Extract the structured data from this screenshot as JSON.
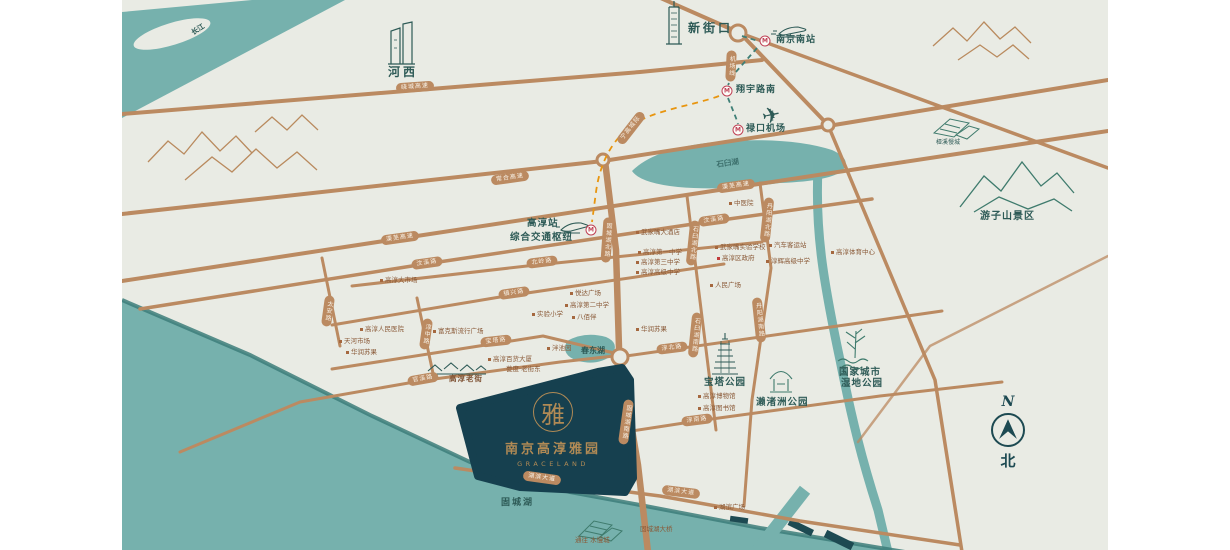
{
  "map": {
    "logo": {
      "title": "南京高淳雅园",
      "subtitle": "GRACELAND",
      "seal": "雅"
    },
    "compass": {
      "n": "N",
      "north": "北"
    },
    "metro_m": "M",
    "colors": {
      "background": "#e9ebe4",
      "water": "#76b1ad",
      "water_edge": "#3d7e7a",
      "road": "#bb8a61",
      "site_polygon": "#16404f",
      "gold": "#b08a55",
      "teal_label": "#2d5a56",
      "poi_label": "#8a5a38",
      "metro_red": "#bf4055",
      "metro_line_s9": "#e8950f",
      "metro_line_s1": "#3f7f76"
    },
    "metro_stations": [
      {
        "x": 765,
        "y": 41
      },
      {
        "x": 727,
        "y": 91
      },
      {
        "x": 738,
        "y": 130
      },
      {
        "x": 591,
        "y": 230
      }
    ],
    "road_pills": [
      {
        "label": "绕城高速",
        "x": 415,
        "y": 87,
        "rot": -4
      },
      {
        "label": "常合高速",
        "x": 510,
        "y": 178,
        "rot": -8
      },
      {
        "label": "溧芜高速",
        "x": 400,
        "y": 238,
        "rot": -8
      },
      {
        "label": "溧芜高速",
        "x": 736,
        "y": 186,
        "rot": -8
      },
      {
        "label": "汶溪路",
        "x": 427,
        "y": 263,
        "rot": -8
      },
      {
        "label": "汶溪路",
        "x": 714,
        "y": 220,
        "rot": -8
      },
      {
        "label": "北岭路",
        "x": 542,
        "y": 262,
        "rot": -7
      },
      {
        "label": "镇兴路",
        "x": 514,
        "y": 293,
        "rot": -8
      },
      {
        "label": "宝塔路",
        "x": 496,
        "y": 341,
        "rot": -6
      },
      {
        "label": "淳北路",
        "x": 672,
        "y": 348,
        "rot": -7
      },
      {
        "label": "官溪路",
        "x": 423,
        "y": 379,
        "rot": -10
      },
      {
        "label": "淳南路",
        "x": 697,
        "y": 420,
        "rot": -7
      },
      {
        "label": "湖滨大道",
        "x": 542,
        "y": 478,
        "rot": 8
      },
      {
        "label": "湖滨大道",
        "x": 681,
        "y": 492,
        "rot": 7
      },
      {
        "label": "宁高城际",
        "x": 631,
        "y": 128,
        "rot": -52
      },
      {
        "label": "机场线",
        "x": 731,
        "y": 66,
        "rot": 3,
        "vertical": true
      },
      {
        "label": "太安路",
        "x": 328,
        "y": 311,
        "rot": 8,
        "vertical": true
      },
      {
        "label": "淳中路",
        "x": 426,
        "y": 334,
        "rot": 8,
        "vertical": true
      },
      {
        "label": "固城湖北路",
        "x": 607,
        "y": 240,
        "rot": 4,
        "vertical": true
      },
      {
        "label": "石臼湖北路",
        "x": 693,
        "y": 243,
        "rot": 6,
        "vertical": true
      },
      {
        "label": "丹阳湖北路",
        "x": 767,
        "y": 220,
        "rot": 6,
        "vertical": true
      },
      {
        "label": "石臼湖南路",
        "x": 695,
        "y": 335,
        "rot": 6,
        "vertical": true
      },
      {
        "label": "丹阳湖南路",
        "x": 759,
        "y": 320,
        "rot": -6,
        "vertical": true
      },
      {
        "label": "固城湖南路",
        "x": 626,
        "y": 422,
        "rot": 8,
        "vertical": true
      }
    ],
    "area_labels": [
      {
        "id": "changjiang",
        "text": "长江",
        "x": 190,
        "y": 30,
        "size": 7,
        "rot": -33
      },
      {
        "id": "hexi",
        "text": "河西",
        "x": 388,
        "y": 66,
        "size": 12,
        "ls": 3
      },
      {
        "id": "xinjiekou",
        "text": "新街口",
        "x": 688,
        "y": 22,
        "size": 12,
        "ls": 3
      },
      {
        "id": "nanjing-south",
        "text": "南京南站",
        "x": 776,
        "y": 36,
        "size": 9,
        "ls": 1
      },
      {
        "id": "xiangyu-south",
        "text": "翔宇路南",
        "x": 736,
        "y": 86,
        "size": 9,
        "ls": 1
      },
      {
        "id": "lukou-airport",
        "text": "禄口机场",
        "x": 746,
        "y": 125,
        "size": 9,
        "ls": 1
      },
      {
        "id": "gaochun-station",
        "text": "高淳站",
        "x": 527,
        "y": 219,
        "size": 9.5,
        "ls": 1
      },
      {
        "id": "transport-hub",
        "text": "综合交通枢纽",
        "x": 510,
        "y": 233,
        "size": 9.5,
        "ls": 1
      },
      {
        "id": "shijiu-lake",
        "text": "石臼湖",
        "x": 716,
        "y": 161,
        "size": 7.5,
        "rot": -8,
        "color": "#3c6f6c"
      },
      {
        "id": "yaxi",
        "text": "桠溪慢城",
        "x": 936,
        "y": 140,
        "size": 6,
        "bold": false
      },
      {
        "id": "youzishan",
        "text": "游子山景区",
        "x": 980,
        "y": 212,
        "size": 10,
        "ls": 1
      },
      {
        "id": "wetland-1",
        "text": "国家城市",
        "x": 839,
        "y": 368,
        "size": 9.5,
        "ls": 1
      },
      {
        "id": "wetland-2",
        "text": "湿地公园",
        "x": 841,
        "y": 379,
        "size": 9.5,
        "ls": 1
      },
      {
        "id": "baota-park",
        "text": "宝塔公园",
        "x": 704,
        "y": 378,
        "size": 9.5,
        "ls": 1
      },
      {
        "id": "laizhuzhou-park",
        "text": "濑渚洲公园",
        "x": 756,
        "y": 398,
        "size": 9.5,
        "ls": 1
      },
      {
        "id": "chundong-lake",
        "text": "春东湖",
        "x": 581,
        "y": 346,
        "size": 8
      },
      {
        "id": "gucheng-lake",
        "text": "固城湖",
        "x": 501,
        "y": 499,
        "size": 9,
        "ls": 2
      },
      {
        "id": "gaochun-old-street",
        "text": "高淳老街",
        "x": 449,
        "y": 375,
        "size": 7.5,
        "color": "#7c4f30",
        "ls": 1
      }
    ],
    "pois": [
      {
        "text": "高淳大市场",
        "x": 380,
        "y": 277,
        "dot": true
      },
      {
        "text": "高淳人民医院",
        "x": 360,
        "y": 326,
        "dot": true
      },
      {
        "text": "天河市场",
        "x": 339,
        "y": 338,
        "dot": true
      },
      {
        "text": "华润苏果",
        "x": 346,
        "y": 349,
        "dot": true
      },
      {
        "text": "富克斯流行广场",
        "x": 433,
        "y": 328,
        "dot": true
      },
      {
        "text": "中医院",
        "x": 729,
        "y": 200,
        "dot": true
      },
      {
        "text": "武家嘴大酒店",
        "x": 636,
        "y": 229,
        "dot": true
      },
      {
        "text": "高淳第一中学",
        "x": 638,
        "y": 249,
        "dot": true
      },
      {
        "text": "高淳第三中学",
        "x": 636,
        "y": 259,
        "dot": true
      },
      {
        "text": "高淳高级中学",
        "x": 636,
        "y": 269,
        "dot": true
      },
      {
        "text": "武家嘴实验学校",
        "x": 715,
        "y": 244,
        "dot": true
      },
      {
        "text": "高淳区政府",
        "x": 717,
        "y": 255,
        "dot": true,
        "red": true
      },
      {
        "text": "人民广场",
        "x": 710,
        "y": 282,
        "dot": true
      },
      {
        "text": "汽车客运站",
        "x": 769,
        "y": 242,
        "dot": true
      },
      {
        "text": "淳辉高级中学",
        "x": 766,
        "y": 258,
        "dot": true
      },
      {
        "text": "高淳体育中心",
        "x": 831,
        "y": 249,
        "dot": true
      },
      {
        "text": "悦达广场",
        "x": 570,
        "y": 290,
        "dot": true
      },
      {
        "text": "高淳第二中学",
        "x": 565,
        "y": 302,
        "dot": true
      },
      {
        "text": "实验小学",
        "x": 532,
        "y": 311,
        "dot": true
      },
      {
        "text": "八佰伴",
        "x": 572,
        "y": 314,
        "dot": true
      },
      {
        "text": "华润苏果",
        "x": 636,
        "y": 326,
        "dot": true
      },
      {
        "text": "泮池园",
        "x": 547,
        "y": 345,
        "dot": true
      },
      {
        "text": "高淳百货大厦",
        "x": 488,
        "y": 356,
        "dot": true
      },
      {
        "text": "甍度·老街东",
        "x": 506,
        "y": 366,
        "dot": false
      },
      {
        "text": "高淳博物馆",
        "x": 698,
        "y": 393,
        "dot": true
      },
      {
        "text": "高淳图书馆",
        "x": 698,
        "y": 405,
        "dot": true
      },
      {
        "text": "湖滨广场",
        "x": 714,
        "y": 504,
        "dot": true
      },
      {
        "text": "固城湖大桥",
        "x": 640,
        "y": 526,
        "dot": false
      },
      {
        "text": "通往 水慢城",
        "x": 575,
        "y": 537,
        "dot": false
      }
    ]
  }
}
